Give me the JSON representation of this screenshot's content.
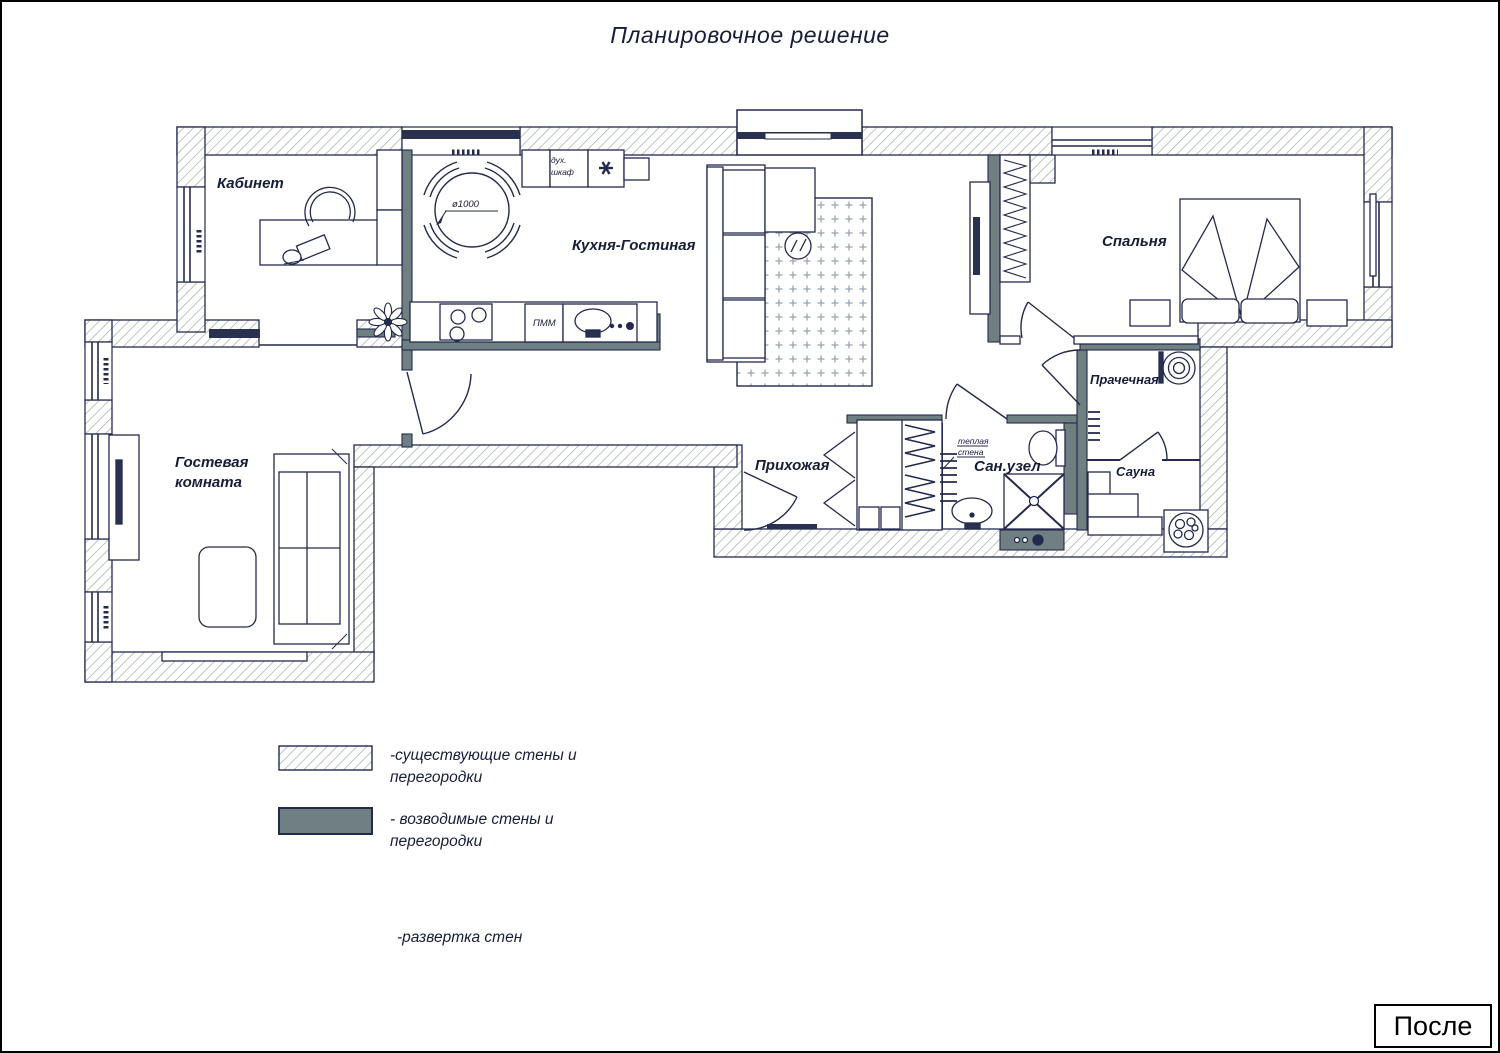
{
  "title": "Планировочное решение",
  "colors": {
    "line": "#232a4d",
    "text": "#161d38",
    "existing_wall_hatch": "#a8b3ae",
    "new_wall_fill": "#6f7f82",
    "rug_dots": "#9aa4ad"
  },
  "rooms": {
    "kabinet": "Кабинет",
    "kitchen_living": "Кухня-Гостиная",
    "bedroom": "Спальня",
    "guest_line1": "Гостевая",
    "guest_line2": "комната",
    "hallway": "Прихожая",
    "bathroom": "Сан.узел",
    "laundry": "Прачечная",
    "sauna": "Сауна"
  },
  "annotations": {
    "oven_line1": "дух.",
    "oven_line2": "шкаф",
    "dishwasher": "ПММ",
    "table_diameter": "ø1000",
    "warm_wall_line1": "теплая",
    "warm_wall_line2": "стена"
  },
  "legend": {
    "existing_line1": "-существующие стены и",
    "existing_line2": "перегородки",
    "new_line1": "- возводимые стены и",
    "new_line2": "перегородки",
    "elevation": "-развертка стен"
  },
  "footer": {
    "stage_label": "После"
  }
}
